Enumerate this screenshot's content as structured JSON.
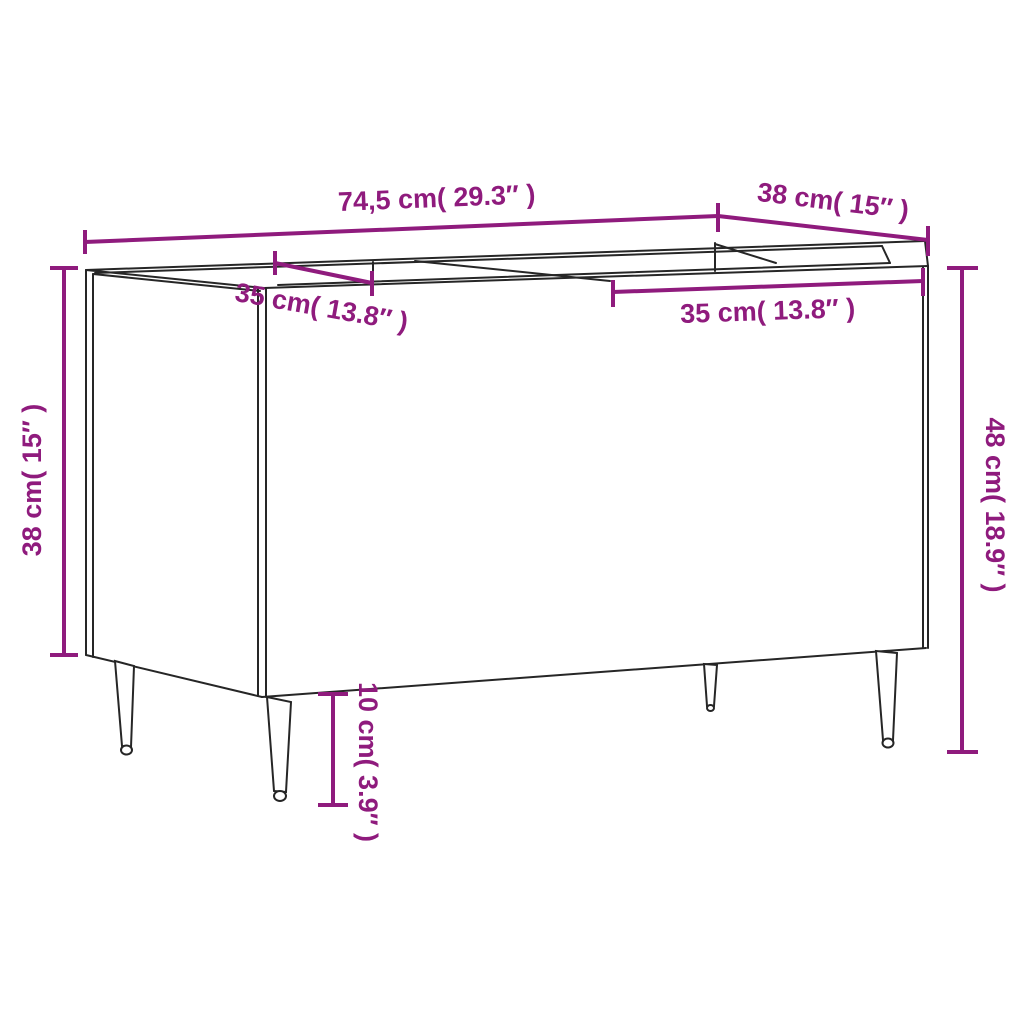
{
  "colors": {
    "accent": "#8f1b7d",
    "line": "#262626",
    "background": "#ffffff"
  },
  "diagram": {
    "kind": "furniture dimension drawing",
    "item": "record cabinet with open top compartments on tapered legs",
    "dims": {
      "top_width": {
        "label": "74,5 cm( 29.3″ )",
        "cm": "74,5",
        "inch": "29.3"
      },
      "top_depth": {
        "label": "38 cm( 15″ )",
        "cm": "38",
        "inch": "15"
      },
      "left_height": {
        "label": "38 cm( 15″ )",
        "cm": "38",
        "inch": "15"
      },
      "right_height": {
        "label": "48 cm( 18.9″ )",
        "cm": "48",
        "inch": "18.9"
      },
      "compartment_left_width": {
        "label": "35 cm( 13.8″ )",
        "cm": "35",
        "inch": "13.8"
      },
      "compartment_right_width": {
        "label": "35 cm( 13.8″ )",
        "cm": "35",
        "inch": "13.8"
      },
      "leg_height": {
        "label": "10 cm( 3.9″ )",
        "cm": "10",
        "inch": "3.9"
      }
    }
  }
}
